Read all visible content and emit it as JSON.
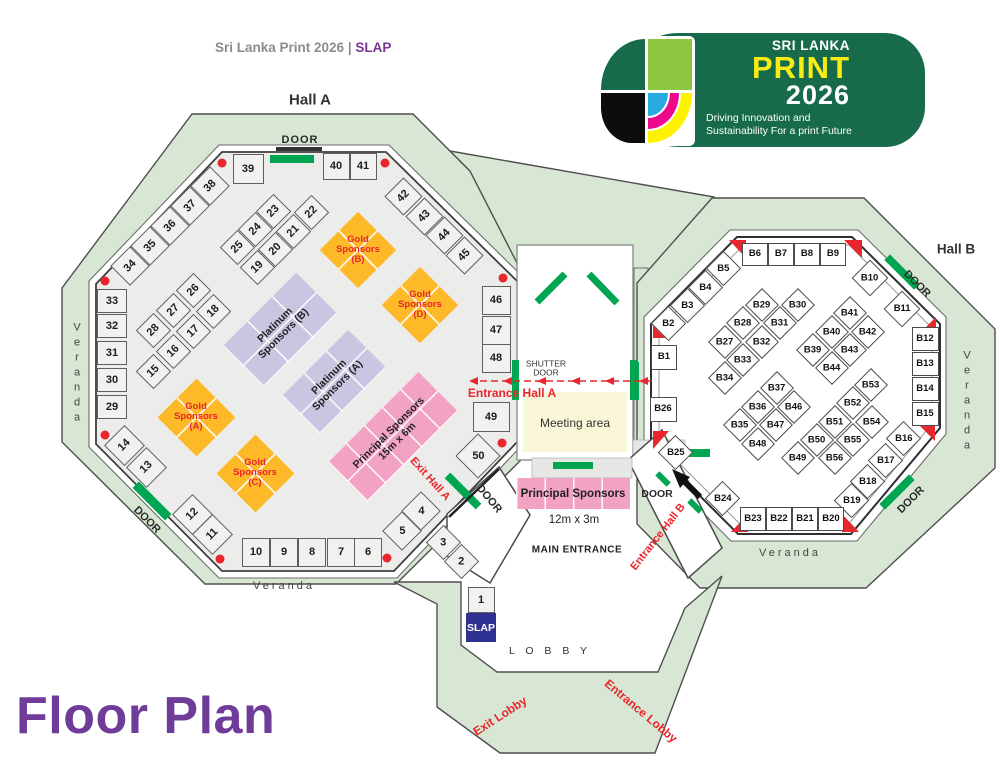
{
  "header": {
    "title": "Sri Lanka Print 2026",
    "separator": "|",
    "brand": "SLAP"
  },
  "page_title": "Floor Plan",
  "logo": {
    "country": "SRI LANKA",
    "word": "PRINT",
    "year": "2026",
    "tagline_line1": "Driving Innovation and",
    "tagline_line2": "Sustainability For a print Future"
  },
  "halls": {
    "a": {
      "title": "Hall A",
      "booths": [
        "1",
        "2",
        "3",
        "4",
        "5",
        "6",
        "7",
        "8",
        "9",
        "10",
        "11",
        "12",
        "13",
        "14",
        "15",
        "16",
        "17",
        "18",
        "19",
        "20",
        "21",
        "22",
        "23",
        "24",
        "25",
        "26",
        "27",
        "28",
        "29",
        "30",
        "31",
        "32",
        "33",
        "34",
        "35",
        "36",
        "37",
        "38",
        "39",
        "40",
        "41",
        "42",
        "43",
        "44",
        "45",
        "46",
        "47",
        "48",
        "49",
        "50"
      ]
    },
    "b": {
      "title": "Hall B",
      "booths": [
        "B1",
        "B2",
        "B3",
        "B4",
        "B5",
        "B6",
        "B7",
        "B8",
        "B9",
        "B10",
        "B11",
        "B12",
        "B13",
        "B14",
        "B15",
        "B16",
        "B17",
        "B18",
        "B19",
        "B20",
        "B21",
        "B22",
        "B23",
        "B24",
        "B25",
        "B26",
        "B27",
        "B28",
        "B29",
        "B30",
        "B31",
        "B32",
        "B33",
        "B34",
        "B35",
        "B36",
        "B37",
        "B39",
        "B40",
        "B41",
        "B42",
        "B43",
        "B44",
        "B46",
        "B47",
        "B48",
        "B49",
        "B50",
        "B51",
        "B52",
        "B53",
        "B54",
        "B55",
        "B56"
      ]
    }
  },
  "labels": {
    "door": "DOOR",
    "veranda": "Veranda",
    "shutter": "SHUTTER",
    "entrance_hall_a": "Entrance Hall A",
    "exit_hall_a": "Exit Hall A",
    "entrance_hall_b": "Entrance Hall B",
    "main_entrance": "MAIN ENTRANCE",
    "lobby": "L O B B Y",
    "exit_lobby": "Exit Lobby",
    "entrance_lobby": "Entrance Lobby",
    "slap": "SLAP"
  },
  "zones": {
    "gold": {
      "line1": "Gold",
      "line2": "Sponsors",
      "units": [
        "(B)",
        "(D)",
        "(A)",
        "(C)"
      ]
    },
    "platinum": {
      "line1": "Platinum",
      "line2": "Sponsors",
      "units": [
        "(B)",
        "(A)"
      ]
    },
    "principal": {
      "name": "Principal Sponsors",
      "size_large": "15m x 6m",
      "size_small": "12m x 3m"
    },
    "meeting": {
      "name": "Meeting area"
    }
  },
  "colors": {
    "gold": "#FDB927",
    "platinum": "#C8C6E0",
    "principal": "#F2A3C4",
    "meeting": "#FAF7D9",
    "veranda": "#D8E7D4",
    "door": "#00A551",
    "alert": "#E8262D",
    "navy": "#2E3192",
    "purple": "#7D3594",
    "brandgreen": "#176B4B",
    "titlepurple": "#6F3D99"
  }
}
